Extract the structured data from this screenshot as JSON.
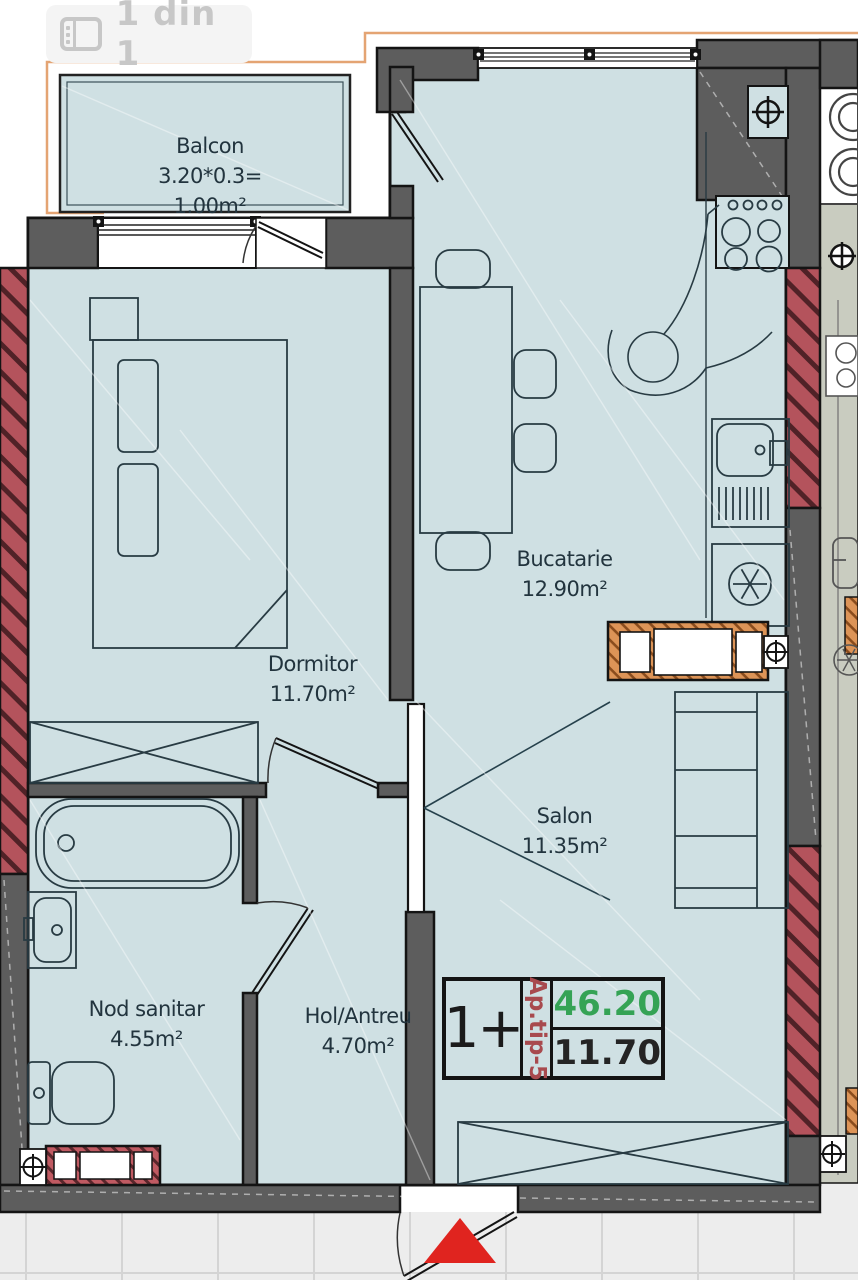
{
  "viewer": {
    "counter_label": "1 din 1"
  },
  "floor_plan": {
    "rooms": [
      {
        "name": "Balcon",
        "dimensions": "3.20*0.3=",
        "area": "1.00m²"
      },
      {
        "name": "Dormitor",
        "area": "11.70m²"
      },
      {
        "name": "Bucatarie",
        "area": "12.90m²"
      },
      {
        "name": "Salon",
        "area": "11.35m²"
      },
      {
        "name": "Nod sanitar",
        "area": "4.55m²"
      },
      {
        "name": "Hol/Antreu",
        "area": "4.70m²"
      }
    ],
    "info_box": {
      "room_count": "1+",
      "apartment_type": "Ap.tip-5",
      "total_area": "46.20",
      "living_area": "11.70"
    },
    "colors": {
      "room_fill": "#cfe0e3",
      "wall_gray": "#5d5d5d",
      "brick_red": "#b4535c",
      "wood_orange": "#dd9457",
      "neighbor_fill": "#c9ccc0",
      "total_area_green": "#35a355",
      "type_red": "#a84a4e",
      "entrance_arrow_red": "#e0241f",
      "boundary_orange": "#e4a473"
    }
  }
}
